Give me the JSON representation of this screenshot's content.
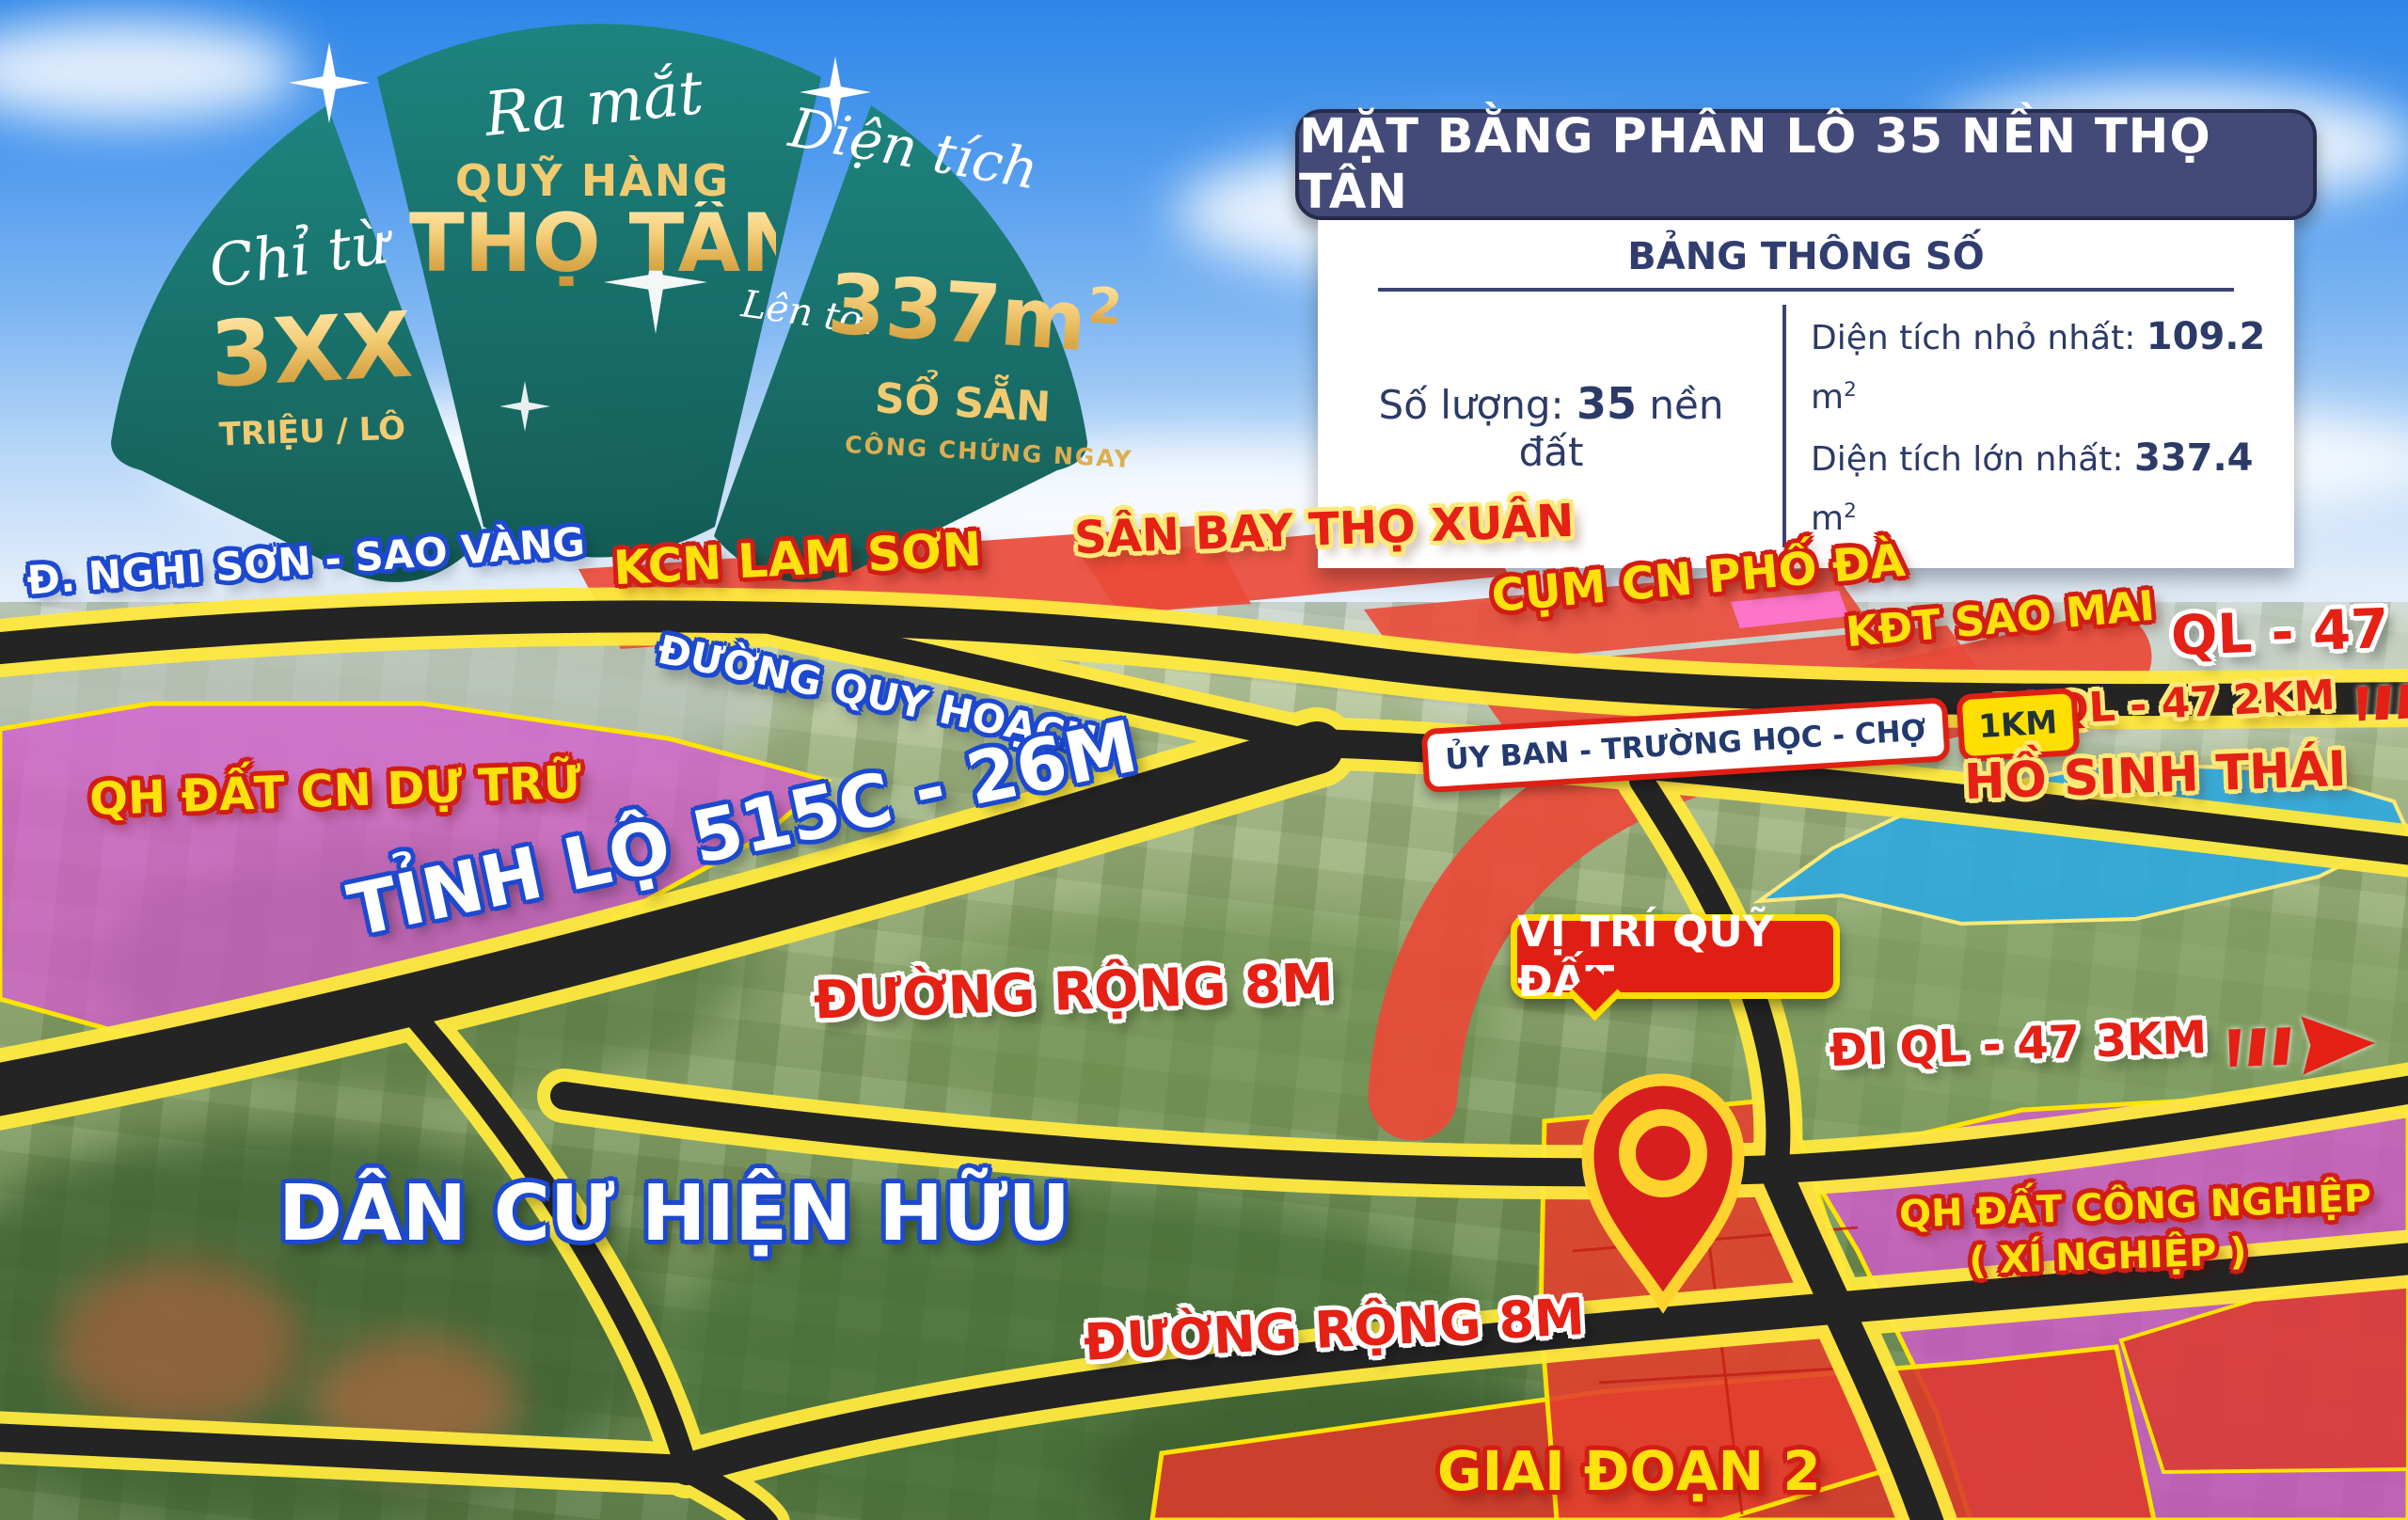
{
  "promo_badge": {
    "launch": "Ra mắt",
    "fund_name_line1": "QUỸ HÀNG",
    "fund_name_line2": "THỌ TÂN",
    "price_prefix": "Chỉ từ",
    "price_value": "3XX",
    "price_unit": "TRIỆU / LÔ",
    "area_title": "Diện tích",
    "area_upto": "Lên tới",
    "area_value": "337m",
    "area_sup": "2",
    "area_note1": "SỔ SẴN",
    "area_note2": "CÔNG CHỨNG NGAY"
  },
  "info_panel": {
    "title": "MẶT BẰNG PHÂN LÔ 35 NỀN THỌ TÂN",
    "subtitle": "BẢNG THÔNG SỐ",
    "quantity_label": "Số lượng:",
    "quantity_value": "35",
    "quantity_suffix": "nền đất",
    "min_area_label": "Diện tích nhỏ nhất:",
    "min_area_value": "109.2",
    "max_area_label": "Diện tích lớn nhất:",
    "max_area_value": "337.4",
    "area_unit": "m",
    "area_unit_sup": "2"
  },
  "map_labels": {
    "nghi_son_road": "Đ. NGHI SƠN - SAO VÀNG",
    "kcn_lam_son": "KCN LAM SƠN",
    "san_bay": "SÂN BAY THỌ XUÂN",
    "cum_cn_pho_da": "CỤM CN PHỐ ĐÀ",
    "kdt_sao_mai": "KĐT SAO MAI",
    "ql_47": "QL - 47",
    "duong_quy_hoach": "ĐƯỜNG QUY HOẠCH",
    "di_ql47_2km": "ĐI QL - 47  2KM",
    "uy_ban": "ỦY BAN - TRƯỜNG HỌC - CHỢ",
    "one_km": "1KM",
    "ho_sinh_thai": "HỒ SINH THÁI",
    "qh_dat_cn_du_tru": "QH ĐẤT CN DỰ TRỮ",
    "tinh_lo_515c": "TỈNH LỘ 515C - 26M",
    "duong_rong_8m_1": "ĐƯỜNG RỘNG 8M",
    "vi_tri_quy_dat": "VỊ TRÍ QUỸ ĐẤT",
    "di_ql47_3km": "ĐI QL - 47  3KM",
    "dan_cu_hien_huu": "DÂN CƯ HIỆN HỮU",
    "qh_dat_cong_nghiep_line1": "QH ĐẤT CÔNG NGHIỆP",
    "qh_dat_cong_nghiep_line2": "( XÍ NGHIỆP )",
    "duong_rong_8m_2": "ĐƯỜNG RỘNG 8M",
    "giai_doan_2": "GIAI ĐOẠN 2"
  },
  "colors": {
    "badge_teal": "#14786f",
    "gold_text": "#f1cb72",
    "panel_navy": "#434a77",
    "panel_text_navy": "#2c3a68",
    "label_blue_outline": "#1c49cf",
    "label_yellow": "#ffe10e",
    "label_red": "#e52015",
    "overlay_magenta": "#d55ad0",
    "overlay_red": "#e2402f",
    "lake_blue": "#2da9e0",
    "road_border_yellow": "#ffe93e",
    "road_black": "#242424"
  }
}
